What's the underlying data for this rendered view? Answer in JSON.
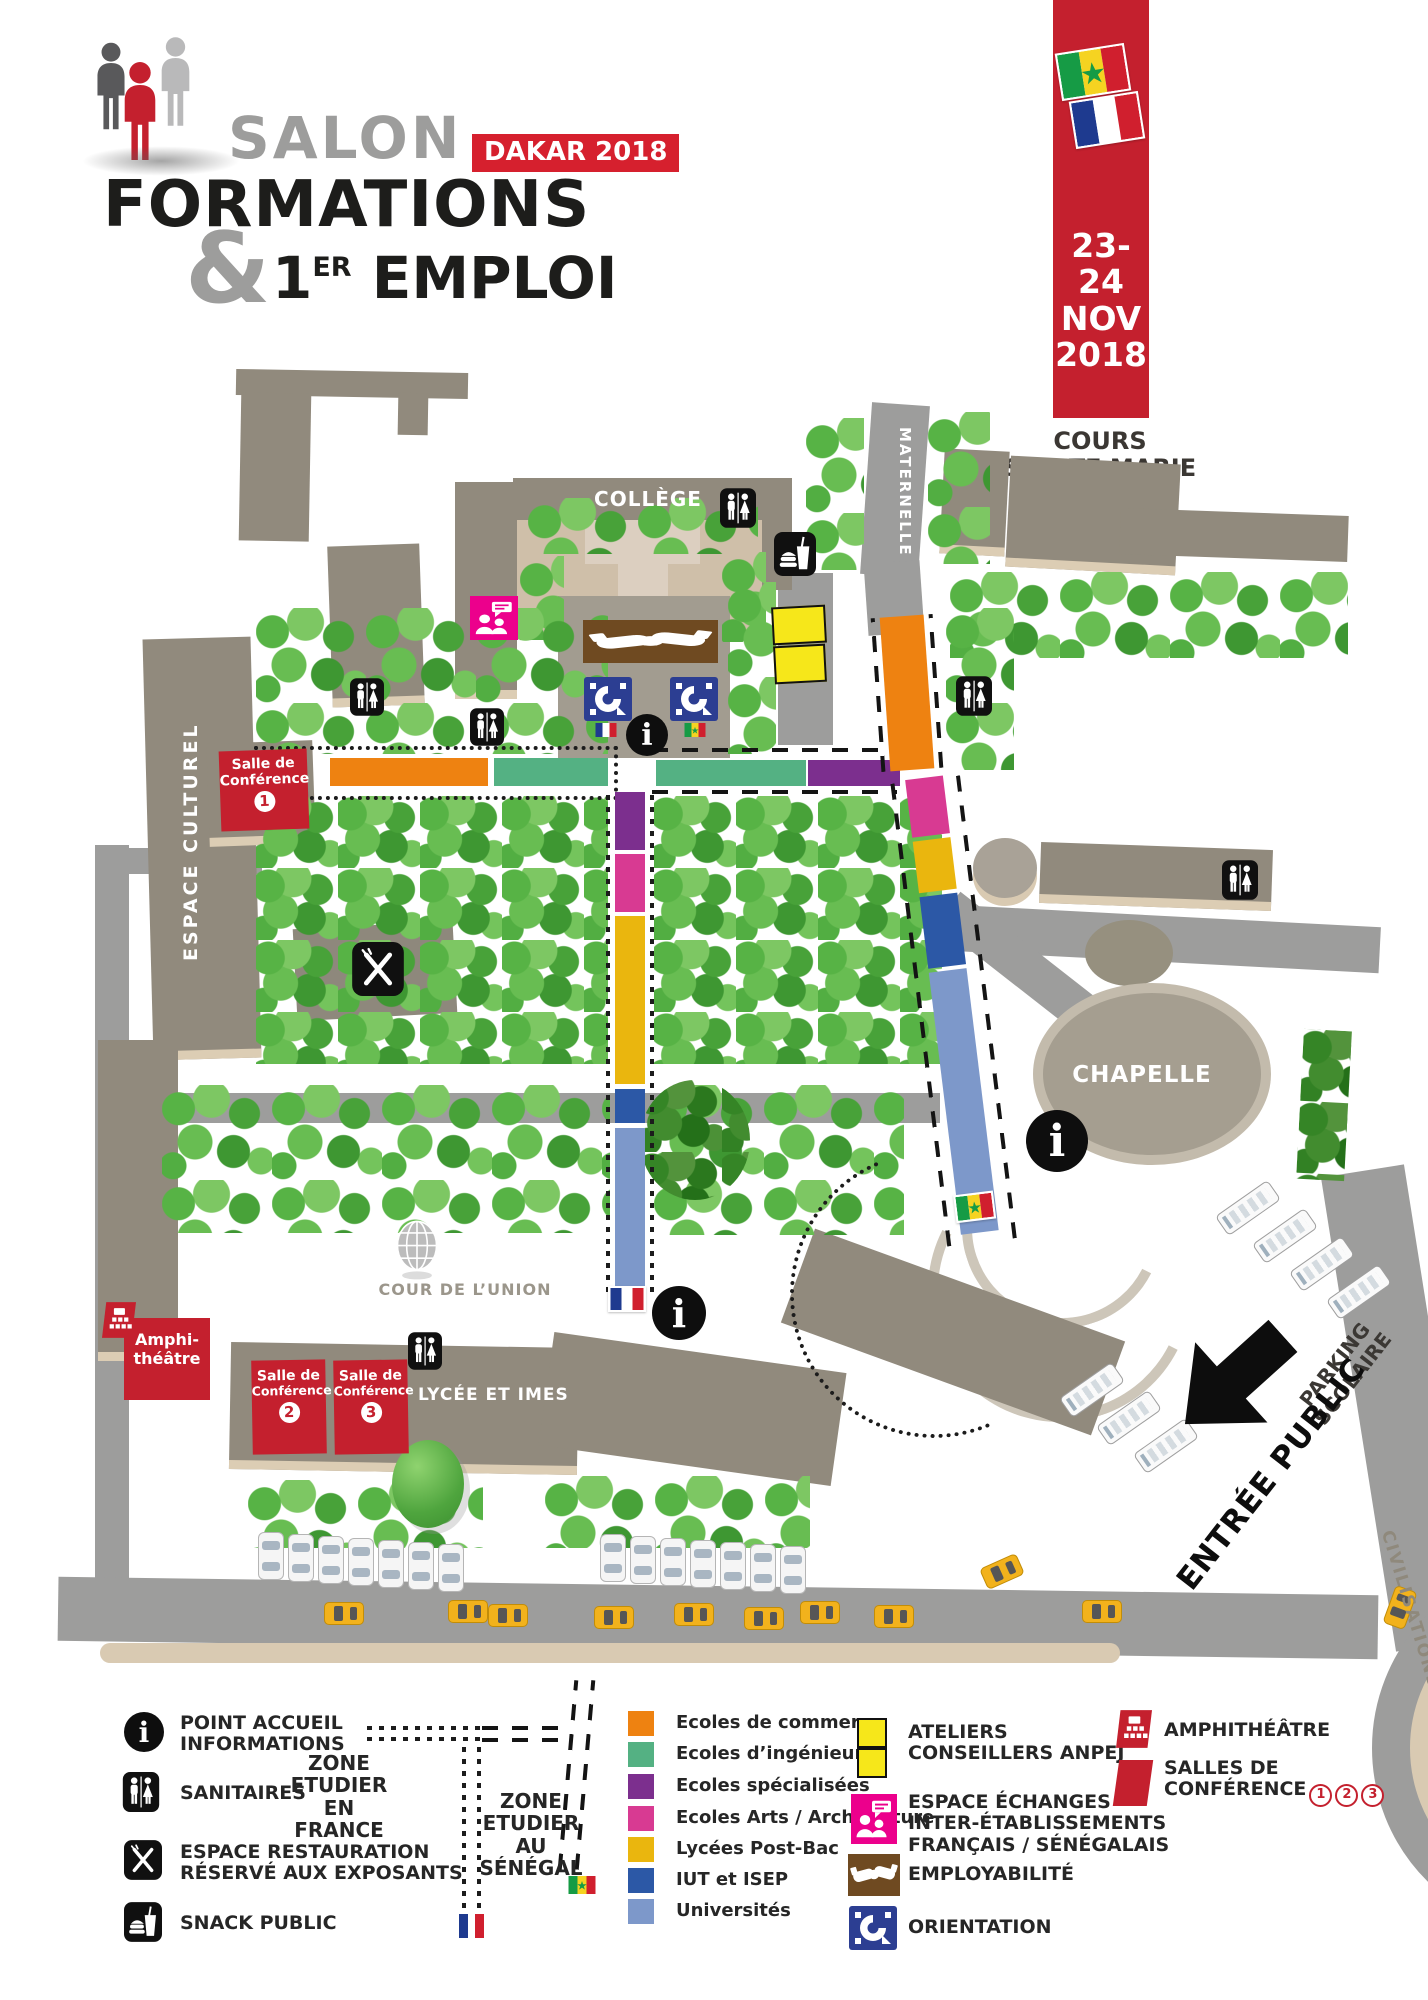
{
  "header": {
    "salon": "SALON",
    "badge": "DAKAR 2018",
    "formations": "FORMATIONS",
    "ampersand": "&",
    "one": "1",
    "er": "ER",
    "emploi": "EMPLOI",
    "date_line1": "23-24",
    "date_line2": "NOV",
    "date_line3": "2018",
    "venue_line1": "COURS",
    "venue_line2": "SAINTE MARIE",
    "venue_line3": "DE HANN"
  },
  "map": {
    "college": "COLLÈGE",
    "maternelle": "MATERNELLE",
    "espace_culturel": "ESPACE CULTUREL",
    "chapelle": "CHAPELLE",
    "cour_union": "COUR DE L’UNION",
    "lycee": "LYCÉE ET IMES",
    "parking_line1": "PARKING",
    "parking_line2": "SCOLAIRE",
    "entree": "ENTRÉE PUBLIC",
    "civilisations": "CIVILISATIONS",
    "amphi_line1": "Amphi-",
    "amphi_line2": "théâtre",
    "salle_line1": "Salle de",
    "salle_line2": "Conférence",
    "salle1_num": "1",
    "salle2_num": "2",
    "salle3_num": "3"
  },
  "legend": {
    "facilities": [
      {
        "label1": "POINT ACCUEIL",
        "label2": "INFORMATIONS"
      },
      {
        "label1": "SANITAIRES",
        "label2": ""
      },
      {
        "label1": "ESPACE RESTAURATION",
        "label2": "RÉSERVÉ AUX EXPOSANTS"
      },
      {
        "label1": "SNACK PUBLIC",
        "label2": ""
      }
    ],
    "zone_france": {
      "l1": "ZONE",
      "l2": "ETUDIER",
      "l3": "EN",
      "l4": "FRANCE"
    },
    "zone_senegal": {
      "l1": "ZONE",
      "l2": "ETUDIER",
      "l3": "AU",
      "l4": "SÉNÉGAL"
    },
    "categories": [
      {
        "label": "Ecoles de commerce",
        "color": "#ee8211"
      },
      {
        "label": "Ecoles d’ingénieurs",
        "color": "#54b183"
      },
      {
        "label": "Ecoles spécialisées",
        "color": "#7c2f8e"
      },
      {
        "label": "Ecoles Arts / Architecture",
        "color": "#d83a92"
      },
      {
        "label": "Lycées Post-Bac",
        "color": "#eab60e"
      },
      {
        "label": "IUT et ISEP",
        "color": "#2c58a6"
      },
      {
        "label": "Universités",
        "color": "#7d98ca"
      }
    ],
    "activities": [
      {
        "label1": "ATELIERS",
        "label2": "CONSEILLERS ANPEJ",
        "label3": ""
      },
      {
        "label1": "ESPACE ÉCHANGES",
        "label2": "INTER-ÉTABLISSEMENTS",
        "label3": "FRANÇAIS / SÉNÉGALAIS"
      },
      {
        "label1": "EMPLOYABILITÉ",
        "label2": "",
        "label3": ""
      },
      {
        "label1": "ORIENTATION",
        "label2": "",
        "label3": ""
      }
    ],
    "rooms": {
      "amphi": "AMPHITHÉÂTRE",
      "salles_line1": "SALLES DE",
      "salles_line2": "CONFÉRENCE",
      "salles_numbers": [
        "1",
        "2",
        "3"
      ]
    }
  },
  "colors": {
    "brand_red": "#c4202e",
    "building_grey": "#918a7d",
    "building_base": "#dccdb4",
    "road_grey": "#9d9d9c",
    "tree_green": "#57b345",
    "orange": "#ee8211",
    "teal": "#54b183",
    "purple": "#7c2f8e",
    "pink": "#d83a92",
    "gold": "#eab60e",
    "blue": "#2c58a6",
    "light_blue": "#7d98ca",
    "bright_yellow": "#f6e71a",
    "brown": "#6f4a21",
    "navy": "#2c3e92",
    "magenta": "#ec008c"
  }
}
